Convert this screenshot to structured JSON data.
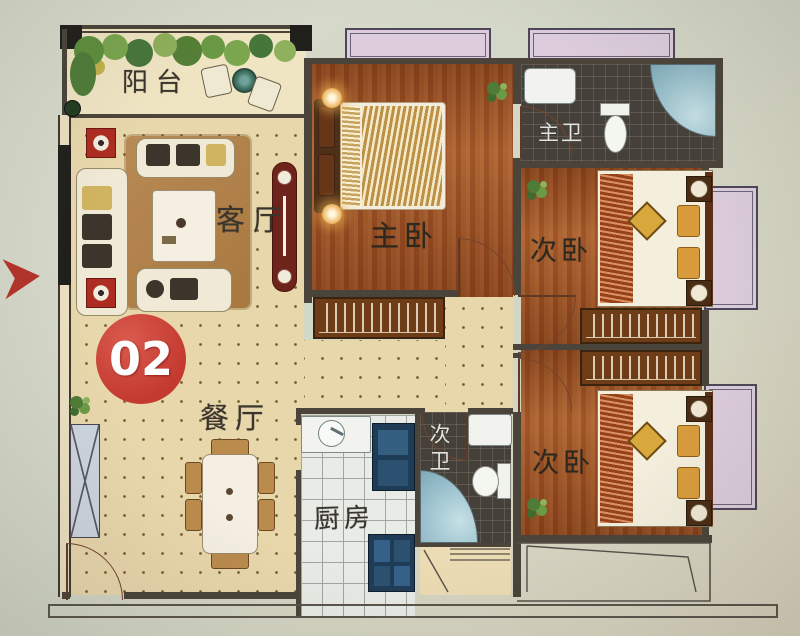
{
  "unit": {
    "number": "02"
  },
  "rooms": {
    "balcony": {
      "label": "阳台"
    },
    "living_room": {
      "label": "客厅"
    },
    "dining_room": {
      "label": "餐厅"
    },
    "kitchen": {
      "label": "厨房"
    },
    "master_bedroom": {
      "label": "主卧"
    },
    "master_bathroom": {
      "label": "主卫"
    },
    "second_bathroom": {
      "label": "次卫"
    },
    "bedroom_upper": {
      "label": "次卧"
    },
    "bedroom_lower": {
      "label": "次卧"
    }
  },
  "colors": {
    "badge_red": "#c43a30",
    "arrow_red": "#b5342c",
    "wood_floor": "#9c5426",
    "tile_floor_cream": "#e9d7ac",
    "bath_tile_dark": "#45403a",
    "window_lavender": "#dcccdc",
    "shower_blue": "#9cc2cd",
    "kitchen_counter_blue": "#1f3c57",
    "plant_green": "#6b9a44"
  }
}
